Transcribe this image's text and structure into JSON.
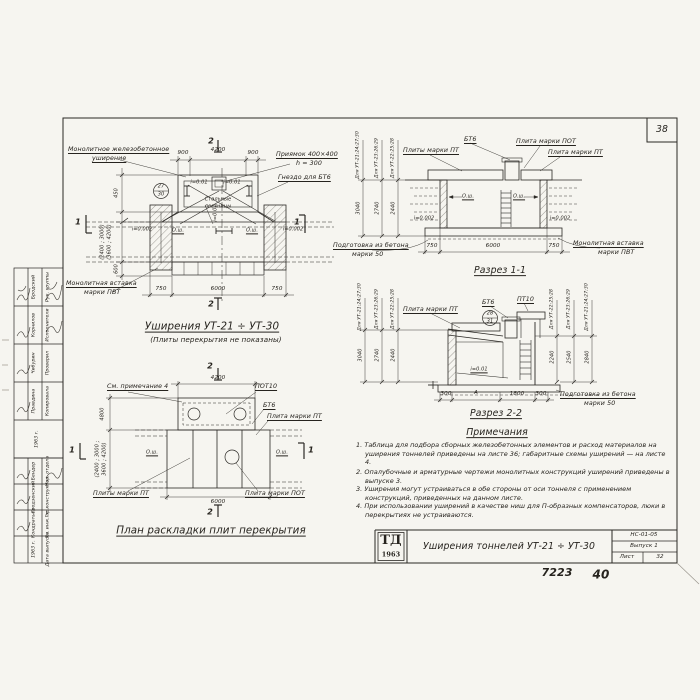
{
  "page": {
    "corner_number": "38",
    "code": "НС-01-05",
    "issue": "Выпуск 1",
    "sheet_label": "Лист",
    "sheet_number": "32",
    "stamp_logo": "ТД",
    "stamp_year": "1963",
    "title_block_title": "Уширения тоннелей УТ-21 ÷ УТ-30",
    "archive_number": "7223",
    "page_number": "40"
  },
  "common": {
    "axis": "О.ш.",
    "slope1": "i=0.01",
    "slope2": "i=0.002"
  },
  "margin": {
    "table1": {
      "rows": [
        {
          "role": "Рук. группы",
          "name": "Бродский"
        },
        {
          "role": "Исполнители",
          "name": "Корнилов"
        },
        {
          "role": "Проверил",
          "name": "Чибурин"
        },
        {
          "role": "Копировала",
          "name": "Правдина"
        }
      ],
      "date": "1963 г."
    },
    "table2": {
      "rows": [
        {
          "role": "Нач. отдела",
          "name": "Бендер"
        },
        {
          "role": "Гл. конструктор",
          "name": "Гродзенский"
        },
        {
          "role": "Гл. инж. пр.",
          "name": "Кондратьев"
        },
        {
          "role": "Дата выпуска",
          "name": "1963 г."
        }
      ]
    }
  },
  "plan": {
    "title": "Уширения УТ-21 ÷ УТ-30",
    "subtitle": "(Плиты перекрытия не показаны)",
    "callout_widening_1": "Монолитное железобетонное",
    "callout_widening_2": "уширение",
    "callout_pit_1": "Приямок 400×400",
    "callout_pit_2": "h = 300",
    "callout_socket": "Гнездо для БТ6",
    "callout_insert_1": "Монолитная вставка",
    "callout_insert_2": "марки ПВТ",
    "ladders_1": "Стальные",
    "ladders_2": "лестницы",
    "detail_top": "27",
    "detail_bottom": "30",
    "dim_top": [
      "900",
      "4200",
      "900"
    ],
    "dim_bottom": [
      "750",
      "6000",
      "750"
    ],
    "dim_left": [
      "450",
      "(2400 ; 3000)",
      "(3600 ; 4200)",
      "600"
    ],
    "mark_1": "1",
    "mark_2": "2"
  },
  "section1": {
    "title": "Разрез 1-1",
    "callout_bt6": "БТ6",
    "callout_pot": "Плита марки ПОТ",
    "callout_pt_left": "Плиты марки ПТ",
    "callout_pt_right": "Плита марки ПТ",
    "callout_base_1": "Подготовка из бетона",
    "callout_base_2": "марки 50",
    "callout_insert_1": "Монолитная вставка",
    "callout_insert_2": "марки ПВТ",
    "dim_bottom": [
      "750",
      "6000",
      "750"
    ],
    "height_dims": [
      {
        "label": "Для УТ-21;24;27;30",
        "value": "3040"
      },
      {
        "label": "Для УТ-23;26;29",
        "value": "2740"
      },
      {
        "label": "Для УТ-22;25;28",
        "value": "2440"
      }
    ]
  },
  "section2": {
    "title": "Разрез 2-2",
    "callout_pt": "Плита марки ПТ",
    "callout_bt6": "БТ6",
    "callout_pt10": "ПТ10",
    "callout_base_1": "Подготовка из бетона",
    "callout_base_2": "марки 50",
    "detail_top": "28",
    "detail_bottom": "31",
    "slope": "i=0.01",
    "dim_bottom": [
      "300",
      "А",
      "1800",
      "300"
    ],
    "height_dims_left": [
      {
        "label": "Для УТ-21;24;27;30",
        "value": "3040"
      },
      {
        "label": "Для УТ-23;26;29",
        "value": "2740"
      },
      {
        "label": "Для УТ-22;25;28",
        "value": "2440"
      }
    ],
    "height_dims_right": [
      {
        "label": "Для УТ-22;25;28",
        "value": "2240"
      },
      {
        "label": "Для УТ-23;26;29",
        "value": "2540"
      },
      {
        "label": "Для УТ-21;24;27;30",
        "value": "2840"
      }
    ]
  },
  "plan2": {
    "title": "План раскладки плит перекрытия",
    "note_ref": "См. примечание 4",
    "label_pot10": "ПОТ10",
    "label_bt6": "БТ6",
    "label_pt": "Плита марки ПТ",
    "label_pt_pl": "Плиты марки ПТ",
    "label_pot": "Плита марки ПОТ",
    "dim_top": "4200",
    "dim_bottom": "6000",
    "dim_left_1": "4800",
    "dim_left_2": "(2400 ; 3000 ;",
    "dim_left_3": "3600 ; 4200)",
    "mark_1": "1",
    "mark_2": "2"
  },
  "notes": {
    "title": "Примечания",
    "items": [
      "1. Таблица для подбора сборных железобетонных элементов и расход материалов на уширения тоннелей приведены на листе 36; габаритные схемы уширений — на листе 4.",
      "2. Опалубочные и арматурные чертежи монолитных конструкций уширений приведены в выпуске 3.",
      "3. Уширения могут устраиваться в обе стороны от оси тоннеля с применением конструкций, приведенных на данном листе.",
      "4. При использовании уширений в качестве ниш для П-образных компенсаторов, люки в перекрытиях не устраиваются."
    ]
  }
}
